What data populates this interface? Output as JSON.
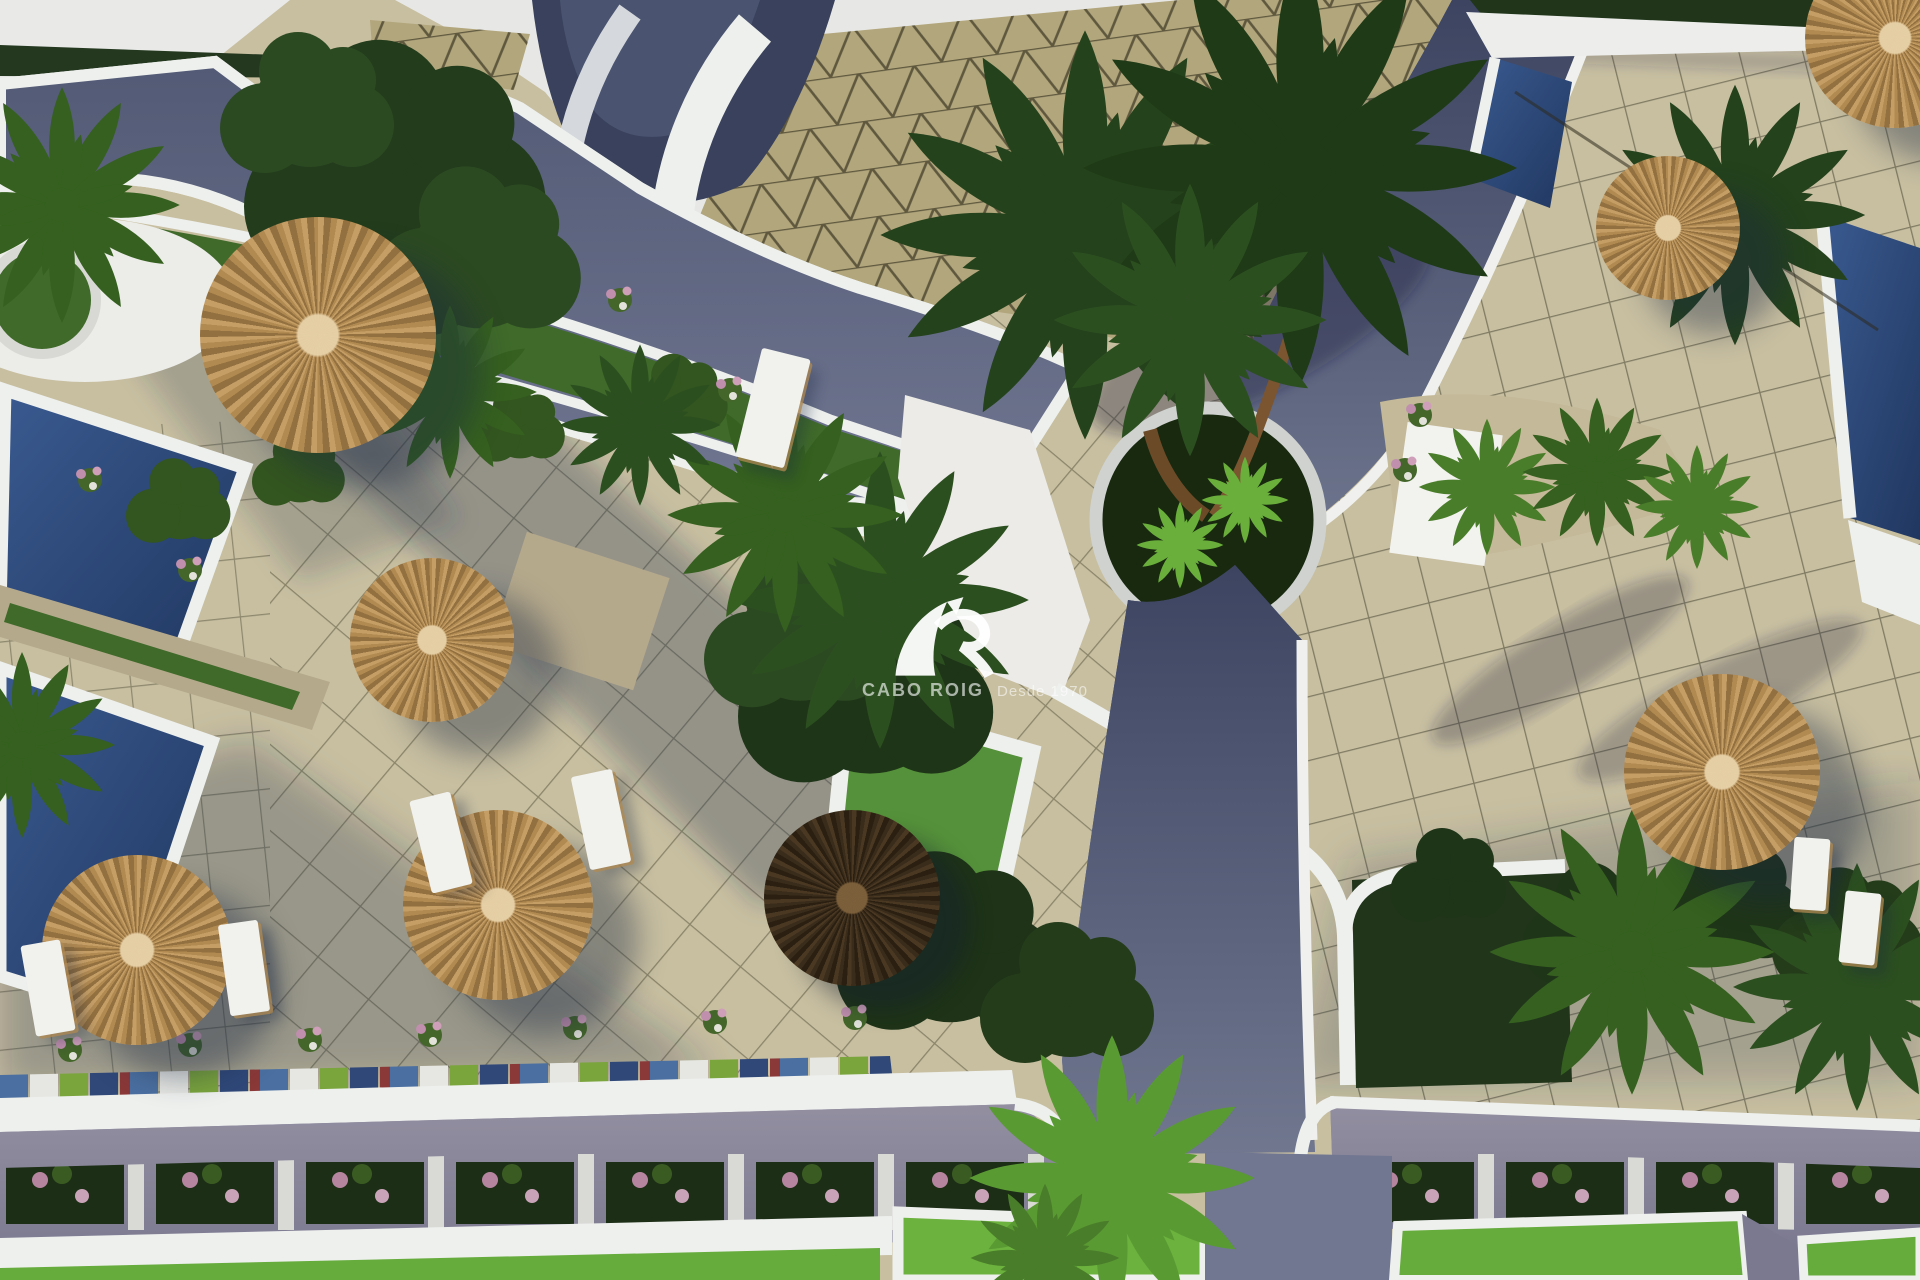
{
  "watermark": {
    "brand": "CABO ROIG",
    "tagline": "Desde 1970"
  },
  "colors": {
    "paving": "#c8bfa1",
    "paving-shade": "#8e9297",
    "grid-line": "#55503a",
    "cobble-dark": "#3c4560",
    "cobble-mid": "#5d657e",
    "road": "#8b889b",
    "pool": "#2f4f80",
    "pool-deep": "#22395f",
    "white-wall": "#f0f1ed",
    "sky": "#e7e8e6",
    "grass": "#4e8030",
    "lawn": "#66ac3c",
    "hedge": "#20351a",
    "palm-dark": "#24421c",
    "palm-bright": "#5a9a33",
    "straw": "#c59e66",
    "straw-dark": "#93703f",
    "umbrella-dark": "#3a2c1a",
    "tile": "#b2a67c",
    "flower-pink": "#c08fae",
    "stone": "#b5a98c"
  },
  "scene": {
    "umbrellas": [
      {
        "x": 318,
        "y": 335,
        "r": 118,
        "variant": "straw"
      },
      {
        "x": 432,
        "y": 640,
        "r": 82,
        "variant": "straw"
      },
      {
        "x": 498,
        "y": 905,
        "r": 95,
        "variant": "straw"
      },
      {
        "x": 137,
        "y": 950,
        "r": 95,
        "variant": "straw"
      },
      {
        "x": 852,
        "y": 898,
        "r": 88,
        "variant": "dark"
      },
      {
        "x": 1668,
        "y": 228,
        "r": 72,
        "variant": "straw"
      },
      {
        "x": 1722,
        "y": 772,
        "r": 98,
        "variant": "straw"
      },
      {
        "x": 1895,
        "y": 38,
        "r": 90,
        "variant": "straw"
      }
    ],
    "loungers": [
      {
        "x": 28,
        "y": 942,
        "w": 40,
        "h": 92,
        "rot": -10
      },
      {
        "x": 224,
        "y": 922,
        "w": 40,
        "h": 92,
        "rot": -8
      },
      {
        "x": 420,
        "y": 795,
        "w": 42,
        "h": 95,
        "rot": -14
      },
      {
        "x": 580,
        "y": 772,
        "w": 42,
        "h": 95,
        "rot": -12
      },
      {
        "x": 1792,
        "y": 838,
        "w": 36,
        "h": 72,
        "rot": 4
      },
      {
        "x": 1842,
        "y": 892,
        "w": 36,
        "h": 72,
        "rot": 6
      },
      {
        "x": 748,
        "y": 352,
        "w": 50,
        "h": 112,
        "rot": 14
      }
    ],
    "palms": [
      {
        "x": 1085,
        "y": 235,
        "s": 3.3,
        "c": "#24421c"
      },
      {
        "x": 1300,
        "y": 168,
        "s": 3.5,
        "c": "#1e3a16"
      },
      {
        "x": 1190,
        "y": 320,
        "s": 2.2,
        "c": "#2c4f20"
      },
      {
        "x": 880,
        "y": 600,
        "s": 2.4,
        "c": "#2c4f20"
      },
      {
        "x": 785,
        "y": 515,
        "s": 1.9,
        "c": "#35601f"
      },
      {
        "x": 450,
        "y": 392,
        "s": 1.4,
        "c": "#35601f"
      },
      {
        "x": 640,
        "y": 425,
        "s": 1.3,
        "c": "#2c4f20"
      },
      {
        "x": 62,
        "y": 205,
        "s": 1.9,
        "c": "#35601f"
      },
      {
        "x": 22,
        "y": 745,
        "s": 1.5,
        "c": "#35601f"
      },
      {
        "x": 1487,
        "y": 487,
        "s": 1.1,
        "c": "#4a7d2a"
      },
      {
        "x": 1597,
        "y": 472,
        "s": 1.2,
        "c": "#35601f"
      },
      {
        "x": 1697,
        "y": 507,
        "s": 1.0,
        "c": "#4a7d2a"
      },
      {
        "x": 1112,
        "y": 1178,
        "s": 2.3,
        "c": "#5a9a33"
      },
      {
        "x": 1632,
        "y": 952,
        "s": 2.3,
        "c": "#35601f"
      },
      {
        "x": 1857,
        "y": 987,
        "s": 2.0,
        "c": "#2c4f20"
      },
      {
        "x": 1735,
        "y": 215,
        "s": 2.1,
        "c": "#24421c"
      },
      {
        "x": 1180,
        "y": 545,
        "s": 0.7,
        "c": "#6aae3c"
      },
      {
        "x": 1245,
        "y": 500,
        "s": 0.7,
        "c": "#6aae3c"
      },
      {
        "x": 1045,
        "y": 1258,
        "s": 1.2,
        "c": "#4a7d2a"
      }
    ],
    "bushes": [
      {
        "x": 400,
        "y": 175,
        "s": 2.6,
        "c": "#223c1c"
      },
      {
        "x": 310,
        "y": 110,
        "s": 1.5,
        "c": "#2c4a22"
      },
      {
        "x": 480,
        "y": 260,
        "s": 1.8,
        "c": "#2c4a22"
      },
      {
        "x": 870,
        "y": 690,
        "s": 2.2,
        "c": "#1f3518"
      },
      {
        "x": 800,
        "y": 640,
        "s": 1.6,
        "c": "#2c4a22"
      },
      {
        "x": 950,
        "y": 950,
        "s": 1.9,
        "c": "#1e3317"
      },
      {
        "x": 1070,
        "y": 1000,
        "s": 1.5,
        "c": "#243c1a"
      },
      {
        "x": 180,
        "y": 505,
        "s": 0.9,
        "c": "#33551f"
      },
      {
        "x": 300,
        "y": 472,
        "s": 0.8,
        "c": "#33551f"
      },
      {
        "x": 520,
        "y": 428,
        "s": 0.8,
        "c": "#33551f"
      },
      {
        "x": 680,
        "y": 398,
        "s": 0.85,
        "c": "#33551f"
      },
      {
        "x": 1600,
        "y": 930,
        "s": 1.3,
        "c": "#1f3518"
      },
      {
        "x": 1725,
        "y": 905,
        "s": 1.4,
        "c": "#1f3518"
      },
      {
        "x": 1850,
        "y": 935,
        "s": 1.3,
        "c": "#243c1a"
      },
      {
        "x": 1450,
        "y": 880,
        "s": 1.0,
        "c": "#1f3518"
      }
    ],
    "tufts": [
      {
        "x": 70,
        "y": 1050
      },
      {
        "x": 190,
        "y": 1045
      },
      {
        "x": 310,
        "y": 1040
      },
      {
        "x": 430,
        "y": 1035
      },
      {
        "x": 575,
        "y": 1028
      },
      {
        "x": 715,
        "y": 1022
      },
      {
        "x": 855,
        "y": 1018
      },
      {
        "x": 190,
        "y": 570
      },
      {
        "x": 730,
        "y": 390
      },
      {
        "x": 1420,
        "y": 415
      },
      {
        "x": 90,
        "y": 480
      },
      {
        "x": 1405,
        "y": 470
      },
      {
        "x": 620,
        "y": 300
      }
    ]
  }
}
